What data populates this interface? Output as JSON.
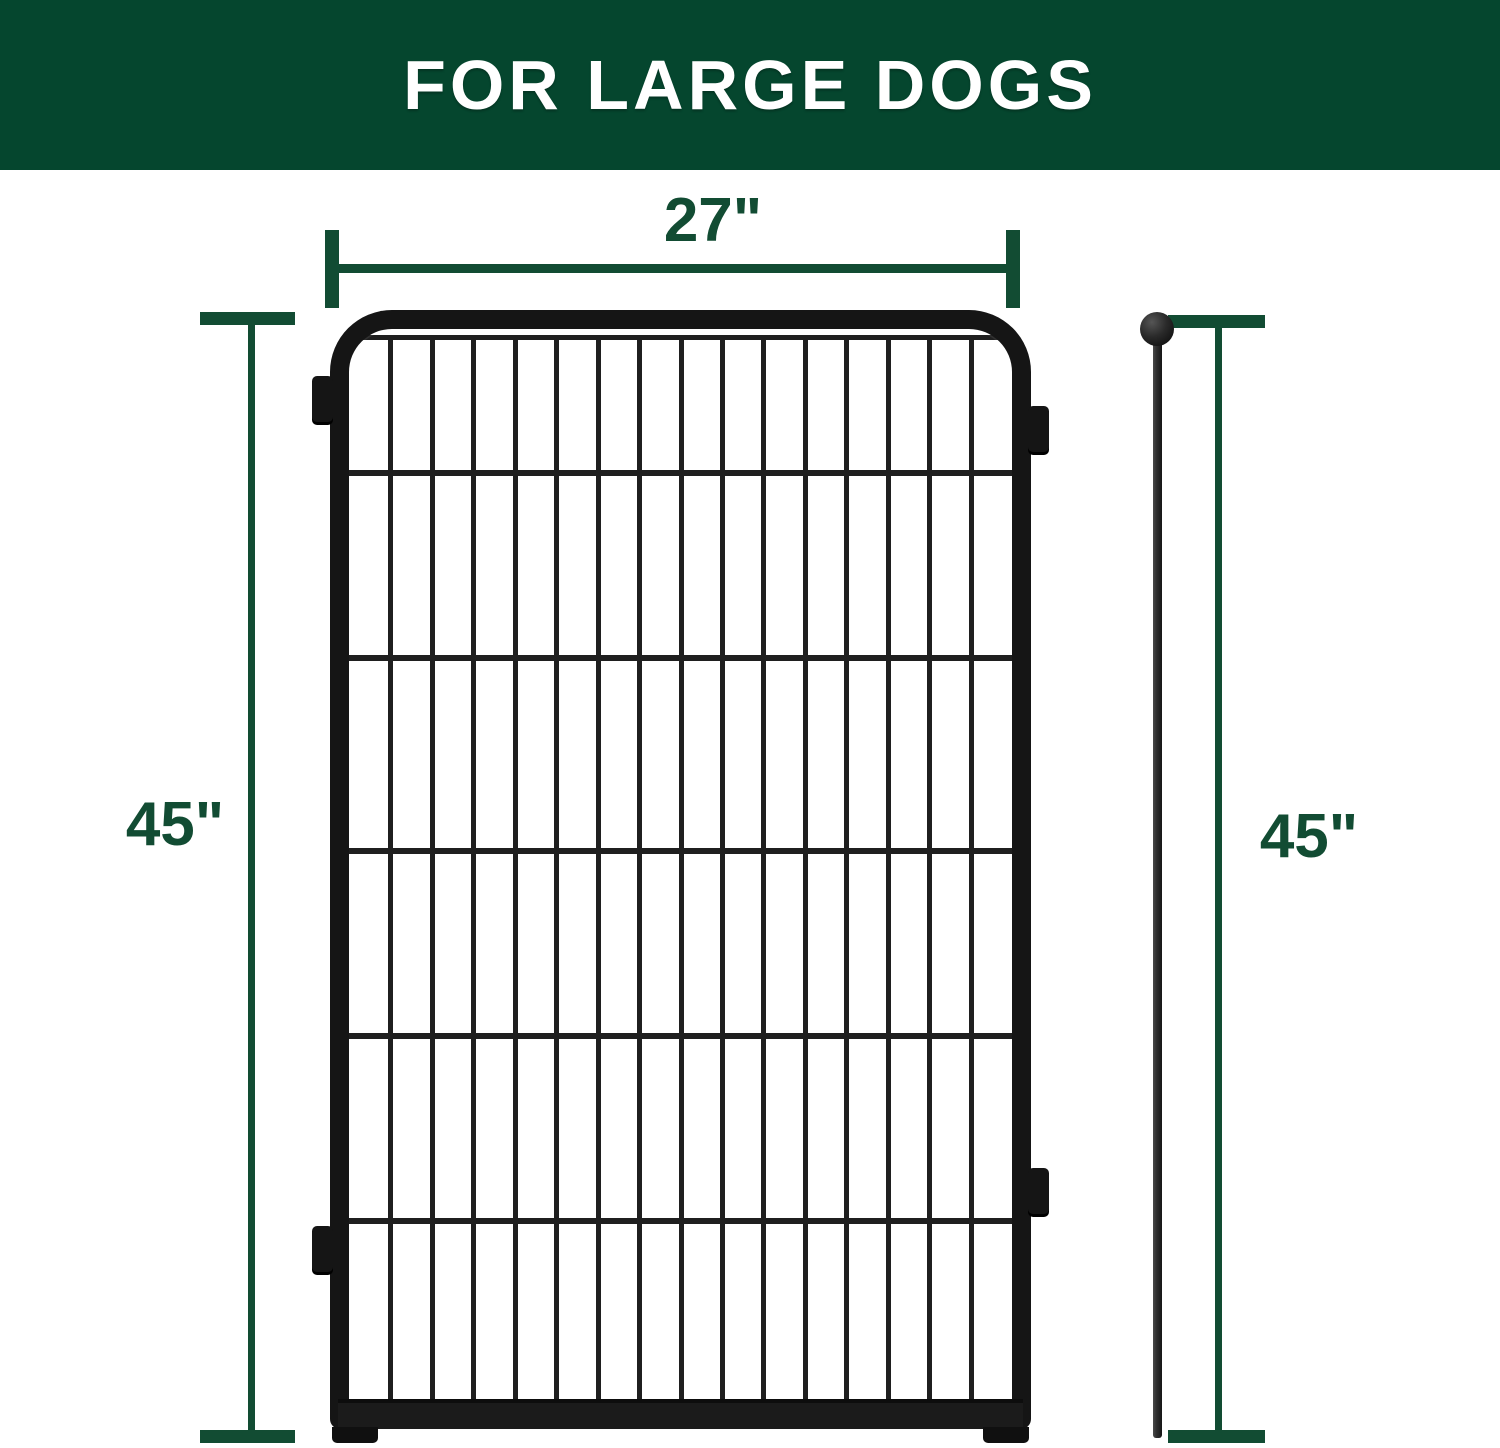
{
  "banner": {
    "title": "FOR LARGE DOGS"
  },
  "dimensions": {
    "width_top": {
      "label": "27\""
    },
    "height_left": {
      "label": "45\""
    },
    "height_right": {
      "label": "45\""
    }
  },
  "figure": {
    "panel": {
      "description": "black metal dog playpen fence panel",
      "vertical_bar_count": 15,
      "horizontal_wire_offsets": [
        141,
        326,
        519,
        704,
        889
      ]
    },
    "stake": {
      "description": "black metal ground stake with ball top"
    }
  },
  "colors": {
    "banner_green": "#05462E",
    "dimension_green": "#124C33",
    "frame_black": "#151515",
    "wire_black": "#1F1F1F",
    "rail_black": "#1B1B1B",
    "stake_gray": "#2E2E2E",
    "background": "#FFFFFF"
  }
}
